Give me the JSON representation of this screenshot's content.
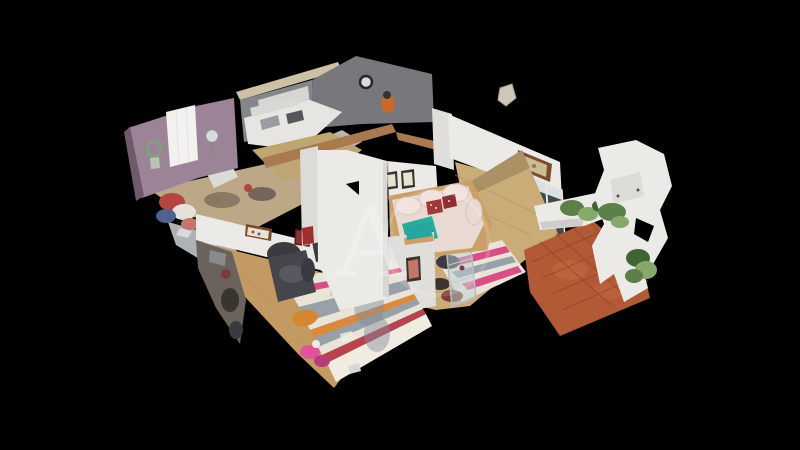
{
  "watermark": {
    "letter": "A"
  },
  "colors": {
    "bg": "#000000",
    "mauve_wall": "#9b8497",
    "mauve_dark": "#6e5a6a",
    "window_white": "#f3f1ee",
    "sage": "#b8c4b4",
    "wreath_green": "#7fa378",
    "desk_tan": "#bca887",
    "clutter_dark": "#8a7a64",
    "clutter_dark2": "#74665a",
    "tile_grey": "#aeb2b6",
    "tile_light": "#d8dadc",
    "clothes_red": "#b5463d",
    "clothes_white": "#e6e1da",
    "clothes_blue": "#51618f",
    "clothes_pink": "#c5766a",
    "beam_stone": "#cdc0a5",
    "wall_stone": "#85858a",
    "wall_stone_dark": "#77777c",
    "clock_face": "#dadad6",
    "clock_ring": "#26262a",
    "bath_wall": "#d7d5d2",
    "door_dark": "#3e3a38",
    "cabinet_white": "#e6e5e2",
    "cabinet_grey": "#9a9ca0",
    "slot_dark": "#55555a",
    "shelf_grey": "#d9d8d5",
    "kitchen_floor": "#b8b4ac",
    "chair_orange": "#c96a2a",
    "cut_wall_tan": "#a97a50",
    "hall_floor": "#bfa571",
    "wall_white": "#eceae7",
    "wall_white_dim": "#e0deda",
    "wall_white_shade": "#d2d0cc",
    "door_panel": "#dddbd8",
    "wardrobe_red": "#a03030",
    "frame_dark": "#3a342e",
    "frame_inner": "#e8e2d2",
    "wood_floor": "#c9ac78",
    "wood_dark": "#b2925e",
    "wood_warm": "#c29a62",
    "sofa_cream": "#e9d9d3",
    "sofa_light": "#f0e2dc",
    "sofa_base": "#caa06a",
    "pillow_red": "#a03838",
    "pillow_red_dark": "#8e3030",
    "throw_teal": "#25b09c",
    "mirror_frame": "#7a4c2c",
    "mirror_inner": "#cbbd93",
    "mirror_dot": "#8a7a4e",
    "table_top": "#dcdad6",
    "plate_dark": "#4c4c50",
    "lamp_yellow": "#e8c44a",
    "glass_blue": "#bcd0d6",
    "rug_cream": "#e9e3d8",
    "rug_pink": "#d84f86",
    "rug_grey": "#98a0a8",
    "rug_orange": "#d98a3e",
    "rug_red": "#b8434f",
    "rug_white": "#f0ece2",
    "cat_orange": "#d5862e",
    "pink_item": "#e0559a",
    "pink_item_dark": "#b83a77",
    "armchair": "#45454c",
    "armchair_dark": "#3a3a40",
    "armchair_light": "#585860",
    "desk_white": "#f1f0ee",
    "clutter_grey": "#6a625c",
    "box_grey": "#8a8a8e",
    "bag_red": "#7a3c34",
    "teal_box": "#28a59e",
    "terracotta": "#b25936",
    "terracotta_line": "#8e4526",
    "terracotta_light": "#c06a42",
    "plant_green": "#5d8048",
    "plant_light": "#86a86a",
    "plant_dark": "#3f6535",
    "ghost_grey": "#828b9b",
    "shard": "#cfc8ba",
    "watermark_white": "#ffffff"
  }
}
